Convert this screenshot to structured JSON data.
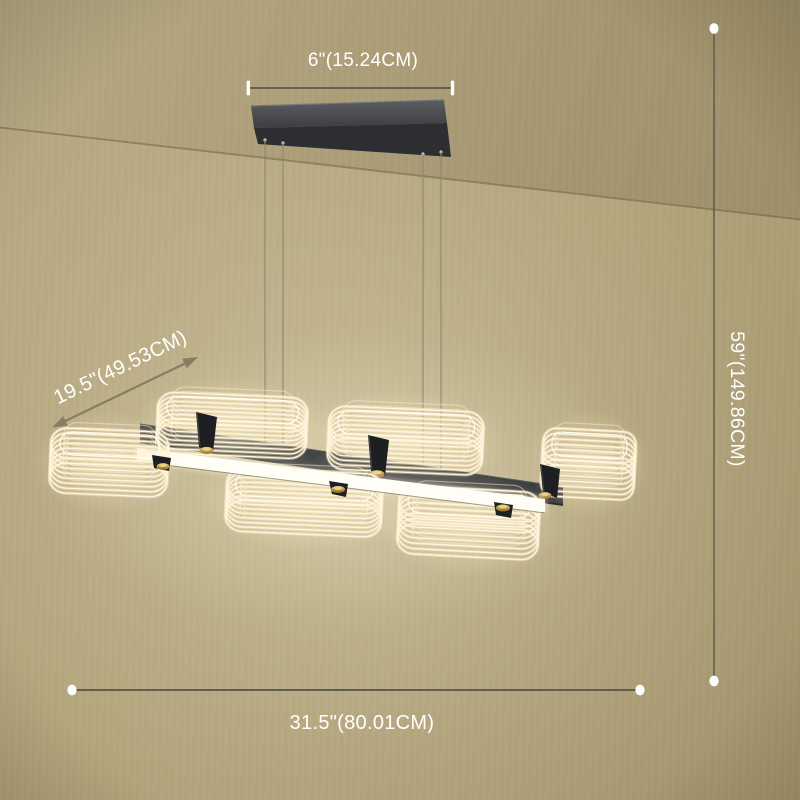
{
  "product_view": {
    "annotations": {
      "canopy_width": "6\"(15.24CM)",
      "fixture_depth": "19.5\"(49.53CM)",
      "hanging_height": "59\"(149.86CM)",
      "fixture_length": "31.5\"(80.01CM)"
    },
    "colors": {
      "wall": "#b0a278",
      "wall_light": "#b8aa84",
      "wall_dark": "#a2946c",
      "ceiling": "#b6a984",
      "ceiling_dark": "#9d8f68",
      "dimension_line": "#56524a",
      "dimension_text": "#ffffff",
      "arrow": "#867e63",
      "endpoint_dot": "#fdfdfd",
      "canopy": "#3c3e42",
      "canopy_underside": "#2c2e31",
      "beam": "#3a3c3f",
      "plate": "#1d1f22",
      "bar": "#fffef6",
      "gold": "#c59e4a",
      "wire": "#fdf5e0",
      "wire_glow": "#ffecc0",
      "cable": "#8f8779"
    }
  }
}
